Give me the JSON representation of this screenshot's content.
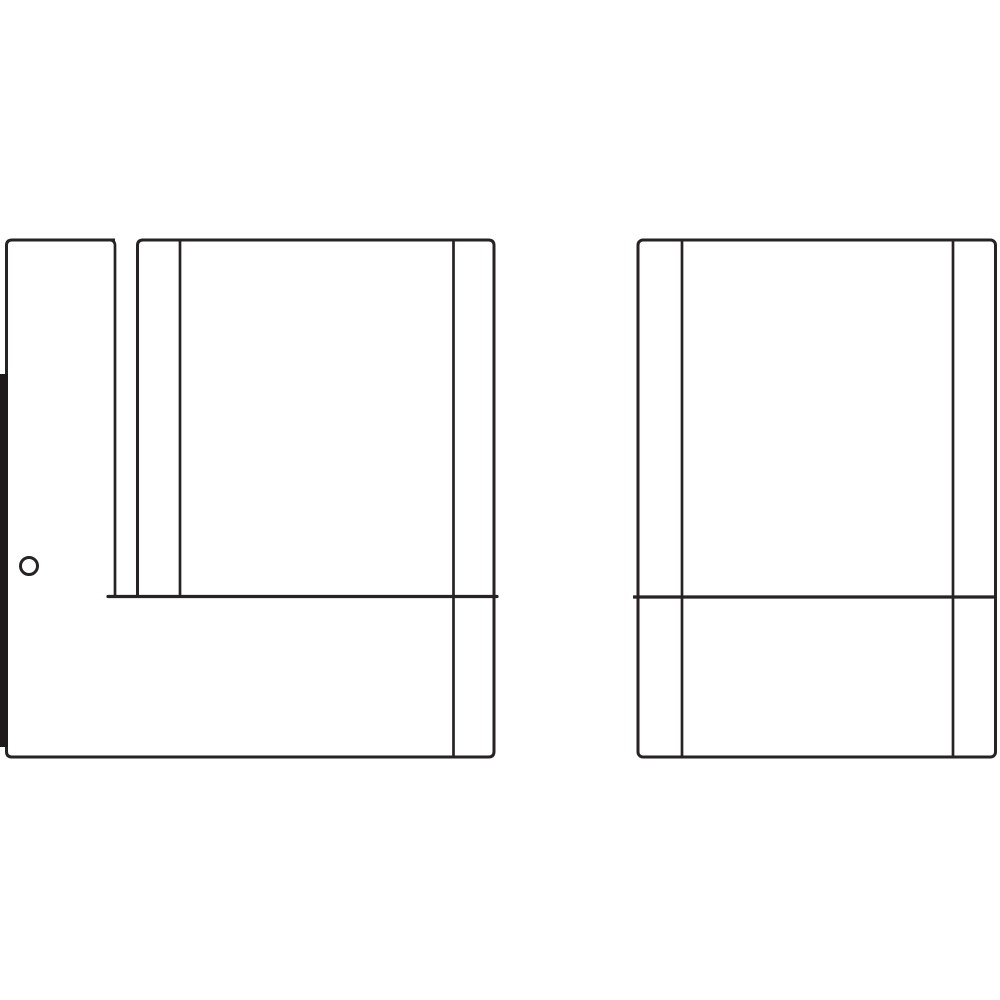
{
  "canvas": {
    "width": 1000,
    "height": 1000,
    "background": "#ffffff"
  },
  "colors": {
    "line": "#272223",
    "solid": "#1e1a1b"
  },
  "drawing": {
    "kind": "technical-line-illustration",
    "description": "Assembly-manual style line drawing of two rectangular cabinet panels. Left panel: narrow door strip at left, thick hinge bar on outer left edge, small screw hole, two inner stiles, full-height right stile, horizontal divider near bottom. Right panel: rounded-corner outline, two inner stiles, horizontal divider near bottom.",
    "elements": [
      {
        "name": "left-cabinet-outline",
        "type": "path",
        "d": "M 115 240 L 12 240 Q 6.5 240 6.5 245.5 L 6.5 751.5 Q 6.5 757 12 757 L 488.5 757 Q 494 757 494 751.5 L 494 245.5 Q 494 240 488.5 240 L 143 240 Q 137.5 240 137.5 245.5 L 137.5 596.5",
        "stroke_width": 3,
        "filled": false,
        "linecap": "butt"
      },
      {
        "name": "left-door-edge",
        "type": "path",
        "d": "M 110 240 Q 115 240.5 115 245.5 L 115 596.5",
        "stroke_width": 2.7,
        "filled": false,
        "linecap": "butt"
      },
      {
        "name": "left-inner-stile",
        "type": "path",
        "d": "M 180 241 L 180 596.5",
        "stroke_width": 2.7,
        "filled": false,
        "linecap": "butt"
      },
      {
        "name": "left-right-stile",
        "type": "path",
        "d": "M 453.5 241 L 453.5 756",
        "stroke_width": 2.7,
        "filled": false,
        "linecap": "butt"
      },
      {
        "name": "left-shelf-line",
        "type": "path",
        "d": "M 108 596.5 L 497 596.5",
        "stroke_width": 3.2,
        "filled": false,
        "linecap": "round"
      },
      {
        "name": "left-hinge-bar",
        "type": "rect",
        "x": 0,
        "y": 374,
        "width": 8,
        "height": 373,
        "filled": true
      },
      {
        "name": "left-screw-hole",
        "type": "circle",
        "cx": 29,
        "cy": 566,
        "r": 8.5,
        "stroke_width": 3,
        "filled": false
      },
      {
        "name": "right-cabinet-outline",
        "type": "rect_rounded",
        "x": 638,
        "y": 240,
        "width": 357.5,
        "height": 517,
        "rx": 5,
        "stroke_width": 3,
        "filled": false
      },
      {
        "name": "right-left-stile",
        "type": "path",
        "d": "M 682 241 L 682 756",
        "stroke_width": 2.7,
        "filled": false,
        "linecap": "butt"
      },
      {
        "name": "right-right-stile",
        "type": "path",
        "d": "M 953 241 L 953 756",
        "stroke_width": 2.7,
        "filled": false,
        "linecap": "butt"
      },
      {
        "name": "right-shelf-line",
        "type": "path",
        "d": "M 633 597 L 995.5 597",
        "stroke_width": 3.2,
        "filled": false,
        "linecap": "butt"
      }
    ]
  }
}
